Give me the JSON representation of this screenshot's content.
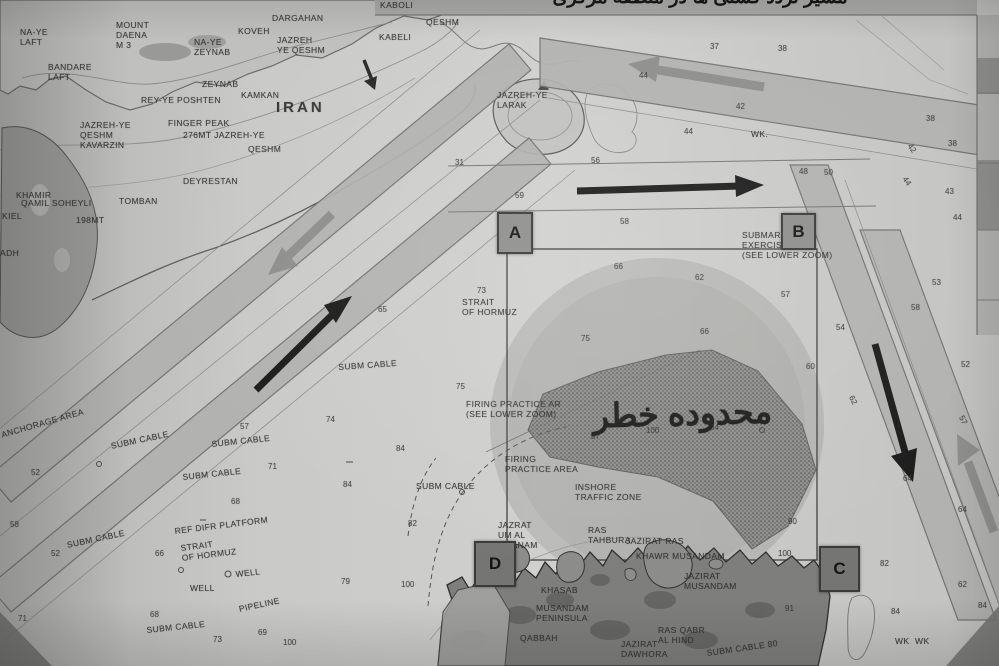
{
  "title_bar": {
    "text": "مسیر تردد کشتی ها در منطقه مرکزی"
  },
  "map": {
    "country_label": "IRAN",
    "danger_zone_label": {
      "text": "محدوده خطر"
    },
    "colors": {
      "sea": "#c6c6c4",
      "land_dark": "#787876",
      "lane_band": "#b1b1af",
      "route_arrow": "#1c1c1c",
      "tss_arrow": "#8b8b89",
      "danger_circle": "#8f8f8d"
    },
    "corner_markers": [
      {
        "letter": "A",
        "x": 497,
        "y": 212,
        "w": 32,
        "h": 38,
        "dark": false
      },
      {
        "letter": "B",
        "x": 781,
        "y": 213,
        "w": 31,
        "h": 33,
        "dark": false
      },
      {
        "letter": "C",
        "x": 819,
        "y": 546,
        "w": 37,
        "h": 42,
        "dark": true
      },
      {
        "letter": "D",
        "x": 474,
        "y": 541,
        "w": 38,
        "h": 42,
        "dark": true
      }
    ],
    "place_labels": [
      {
        "t": "NA-YE\nLAFT",
        "x": 20,
        "y": 27
      },
      {
        "t": "MOUNT\nDAENA\nM 3",
        "x": 116,
        "y": 20
      },
      {
        "t": "KOVEH",
        "x": 238,
        "y": 26
      },
      {
        "t": "DARGAHAN",
        "x": 272,
        "y": 13
      },
      {
        "t": "KABOLI",
        "x": 380,
        "y": 0
      },
      {
        "t": "QESHM",
        "x": 426,
        "y": 17
      },
      {
        "t": "KABELI",
        "x": 379,
        "y": 32
      },
      {
        "t": "NA-YE\nZEYNAB",
        "x": 194,
        "y": 37
      },
      {
        "t": "JAZREH\nYE QESHM",
        "x": 277,
        "y": 35
      },
      {
        "t": "BANDARE\nLAFT",
        "x": 48,
        "y": 62
      },
      {
        "t": "ZEYNAB",
        "x": 202,
        "y": 79
      },
      {
        "t": "KAMKAN",
        "x": 241,
        "y": 90
      },
      {
        "t": "REY-YE POSHTEN",
        "x": 141,
        "y": 95
      },
      {
        "t": "IRAN",
        "x": 276,
        "y": 103,
        "size": 15,
        "bold": 1,
        "ls": 3
      },
      {
        "t": "FINGER PEAK",
        "x": 168,
        "y": 118
      },
      {
        "t": "276MT JAZREH-YE",
        "x": 183,
        "y": 130
      },
      {
        "t": "QESHM",
        "x": 248,
        "y": 144
      },
      {
        "t": "JAZREH-YE\nQESHM\nKAVARZIN",
        "x": 80,
        "y": 120
      },
      {
        "t": "DEYRESTAN",
        "x": 183,
        "y": 176
      },
      {
        "t": "KHAMIR",
        "x": 16,
        "y": 190
      },
      {
        "t": "QAMIL SOHEYLI",
        "x": 21,
        "y": 198
      },
      {
        "t": "TOMBAN",
        "x": 119,
        "y": 196
      },
      {
        "t": "198MT",
        "x": 76,
        "y": 215
      },
      {
        "t": "KIEL",
        "x": 2,
        "y": 211
      },
      {
        "t": "ADH",
        "x": 0,
        "y": 248
      },
      {
        "t": "JAZREH-YE\nLARAK",
        "x": 497,
        "y": 90
      },
      {
        "t": "STRAIT\nOF HORMUZ",
        "x": 462,
        "y": 297
      },
      {
        "t": "SUBM CABLE",
        "x": 338,
        "y": 362,
        "rot": -4
      },
      {
        "t": "SUBM CABLE",
        "x": 110,
        "y": 441,
        "rot": -12
      },
      {
        "t": "SUBM CABLE",
        "x": 211,
        "y": 439,
        "rot": -6
      },
      {
        "t": "SUBM CABLE",
        "x": 182,
        "y": 472,
        "rot": -6
      },
      {
        "t": "SUBM CABLE",
        "x": 66,
        "y": 540,
        "rot": -12
      },
      {
        "t": "SUBM CABLE",
        "x": 146,
        "y": 625,
        "rot": -6
      },
      {
        "t": "SUBM CABLE",
        "x": 416,
        "y": 481
      },
      {
        "t": "SUBM CABLE 80",
        "x": 706,
        "y": 648,
        "rot": -8
      },
      {
        "t": "ANCHORAGE AREA",
        "x": 0,
        "y": 430,
        "rot": -16
      },
      {
        "t": "REF DIFR PLATFORM",
        "x": 174,
        "y": 526,
        "rot": -7
      },
      {
        "t": "STRAIT\nOF HORMUZ",
        "x": 180,
        "y": 543,
        "rot": -7
      },
      {
        "t": "WELL",
        "x": 190,
        "y": 583
      },
      {
        "t": "WELL",
        "x": 235,
        "y": 569,
        "rot": -6
      },
      {
        "t": "PIPELINE",
        "x": 238,
        "y": 604,
        "rot": -12
      },
      {
        "t": "FIRING PRACTICE AR\n(SEE LOWER ZOOM)",
        "x": 466,
        "y": 399
      },
      {
        "t": "FIRING\nPRACTICE AREA",
        "x": 505,
        "y": 454
      },
      {
        "t": "INSHORE\nTRAFFIC ZONE",
        "x": 575,
        "y": 482
      },
      {
        "t": "SUBMARINE\nEXERCISE AREA\n(SEE LOWER ZOOM)",
        "x": 742,
        "y": 230
      },
      {
        "t": "JAZRAT\nUM AL\nGHANAM",
        "x": 498,
        "y": 520
      },
      {
        "t": "RAS\nTAHBURA",
        "x": 588,
        "y": 525
      },
      {
        "t": "JAZIRAT RAS",
        "x": 626,
        "y": 536
      },
      {
        "t": "KHAWR MUSANDAM",
        "x": 636,
        "y": 551
      },
      {
        "t": "JAZIRAT\nMUSANDAM",
        "x": 684,
        "y": 571
      },
      {
        "t": "KHASAB",
        "x": 541,
        "y": 585
      },
      {
        "t": "MUSANDAM\nPENINSULA",
        "x": 536,
        "y": 603
      },
      {
        "t": "QABBAH",
        "x": 520,
        "y": 633
      },
      {
        "t": "RAS QABR\nAL HIND",
        "x": 658,
        "y": 625
      },
      {
        "t": "JAZIRAT\nDAWHORA",
        "x": 621,
        "y": 639
      },
      {
        "t": "WK.",
        "x": 751,
        "y": 129
      },
      {
        "t": "WK  WK",
        "x": 895,
        "y": 636
      }
    ],
    "depth_numbers": [
      {
        "v": "37",
        "x": 710,
        "y": 42
      },
      {
        "v": "38",
        "x": 778,
        "y": 44
      },
      {
        "v": "44",
        "x": 639,
        "y": 71
      },
      {
        "v": "42",
        "x": 736,
        "y": 102
      },
      {
        "v": "44",
        "x": 684,
        "y": 127
      },
      {
        "v": "31",
        "x": 455,
        "y": 158
      },
      {
        "v": "56",
        "x": 591,
        "y": 156
      },
      {
        "v": "59",
        "x": 515,
        "y": 191
      },
      {
        "v": "58",
        "x": 620,
        "y": 217
      },
      {
        "v": "48",
        "x": 799,
        "y": 167
      },
      {
        "v": "50",
        "x": 824,
        "y": 168
      },
      {
        "v": "66",
        "x": 614,
        "y": 262
      },
      {
        "v": "62",
        "x": 695,
        "y": 273
      },
      {
        "v": "57",
        "x": 781,
        "y": 290
      },
      {
        "v": "73",
        "x": 477,
        "y": 286
      },
      {
        "v": "75",
        "x": 581,
        "y": 334
      },
      {
        "v": "66",
        "x": 700,
        "y": 327
      },
      {
        "v": "60",
        "x": 806,
        "y": 362
      },
      {
        "v": "62",
        "x": 855,
        "y": 394,
        "rot": 62
      },
      {
        "v": "54",
        "x": 836,
        "y": 323
      },
      {
        "v": "53",
        "x": 932,
        "y": 278
      },
      {
        "v": "58",
        "x": 911,
        "y": 303
      },
      {
        "v": "52",
        "x": 961,
        "y": 360
      },
      {
        "v": "57",
        "x": 965,
        "y": 414,
        "rot": 62
      },
      {
        "v": "64",
        "x": 903,
        "y": 474
      },
      {
        "v": "38",
        "x": 926,
        "y": 114
      },
      {
        "v": "38",
        "x": 948,
        "y": 139
      },
      {
        "v": "42",
        "x": 913,
        "y": 142,
        "rot": 55
      },
      {
        "v": "44",
        "x": 908,
        "y": 175,
        "rot": 55
      },
      {
        "v": "43",
        "x": 945,
        "y": 187
      },
      {
        "v": "44",
        "x": 953,
        "y": 213
      },
      {
        "v": "65",
        "x": 378,
        "y": 305
      },
      {
        "v": "74",
        "x": 326,
        "y": 415
      },
      {
        "v": "84",
        "x": 396,
        "y": 444
      },
      {
        "v": "84",
        "x": 343,
        "y": 480
      },
      {
        "v": "82",
        "x": 408,
        "y": 519
      },
      {
        "v": "75",
        "x": 456,
        "y": 382
      },
      {
        "v": "87",
        "x": 591,
        "y": 432
      },
      {
        "v": "100",
        "x": 646,
        "y": 426
      },
      {
        "v": "84",
        "x": 710,
        "y": 423
      },
      {
        "v": "52",
        "x": 31,
        "y": 468
      },
      {
        "v": "57",
        "x": 240,
        "y": 422
      },
      {
        "v": "71",
        "x": 268,
        "y": 462
      },
      {
        "v": "68",
        "x": 231,
        "y": 497
      },
      {
        "v": "58",
        "x": 10,
        "y": 520
      },
      {
        "v": "52",
        "x": 51,
        "y": 549
      },
      {
        "v": "71",
        "x": 18,
        "y": 614
      },
      {
        "v": "66",
        "x": 155,
        "y": 549
      },
      {
        "v": "68",
        "x": 150,
        "y": 610
      },
      {
        "v": "73",
        "x": 213,
        "y": 635
      },
      {
        "v": "79",
        "x": 341,
        "y": 577
      },
      {
        "v": "100",
        "x": 401,
        "y": 580
      },
      {
        "v": "69",
        "x": 258,
        "y": 628
      },
      {
        "v": "100",
        "x": 283,
        "y": 638
      },
      {
        "v": "90",
        "x": 788,
        "y": 517
      },
      {
        "v": "100",
        "x": 778,
        "y": 549
      },
      {
        "v": "82",
        "x": 880,
        "y": 559
      },
      {
        "v": "84",
        "x": 891,
        "y": 607
      },
      {
        "v": "91",
        "x": 785,
        "y": 604
      },
      {
        "v": "64",
        "x": 958,
        "y": 505
      },
      {
        "v": "62",
        "x": 958,
        "y": 580
      },
      {
        "v": "84",
        "x": 978,
        "y": 601
      }
    ]
  }
}
